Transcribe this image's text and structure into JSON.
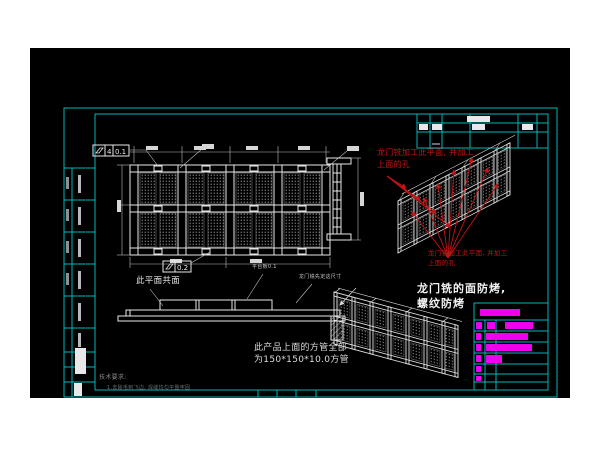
{
  "drawing": {
    "notes": {
      "gantry_note_top_l1": "龙门铣加工此平面, 并加工",
      "gantry_note_top_l2": "上面的孔",
      "gantry_note_mid_l1": "龙门铣加工此平面, 并加工",
      "gantry_note_mid_l2": "上面的孔",
      "antibake_l1": "龙门铣的面防烤,",
      "antibake_l2": "螺纹防烤",
      "tube_l1": "此产品上面的方管全部",
      "tube_l2": "为150*150*10.0方管",
      "coplanar": "此平面共面",
      "platform": "平台板0.1",
      "gantry_dim": "龙门铣先定这尺寸",
      "tech_title": "技术要求:",
      "tech_line1": "1.去除毛刺飞边, 焊缝均匀平整牢固"
    },
    "fcf_top": {
      "qty": "4",
      "value": "0.1"
    },
    "fcf_bottom": {
      "value": "0.2"
    },
    "colors": {
      "background": "#000000",
      "frame_cyan": "#00b8b8",
      "line_white": "#e8e8e8",
      "annotation_red": "#c41414",
      "table_magenta": "#ee00ee"
    }
  }
}
